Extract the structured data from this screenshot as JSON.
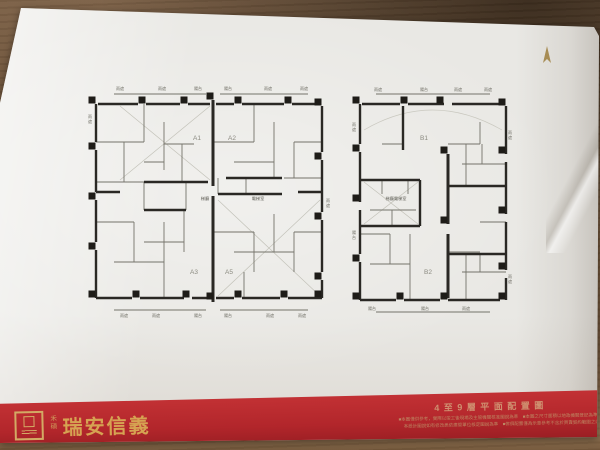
{
  "scene": {
    "desk_color": "#6c5238",
    "paper_color": "#e9e8e4",
    "band_color": "#b2262b",
    "gold": "#d3aa64"
  },
  "compass": {
    "direction": "N",
    "color": "#a78c54"
  },
  "footer": {
    "brand_small": "禾碩",
    "brand": "瑞安信義",
    "sheet_title": "4至9層平面配置圖",
    "disclaimer_line1": "■本圖僅供參考，實際以竣工後現場及主管機關核准圖說為準　■本圖之尺寸面積以地政機關登記為準",
    "disclaimer_line2": "本設計圖說如有修改悉依建管單位核定圖說為準　■傢俱配置僅為示意參考不含於買賣契約範圍之內"
  },
  "plans": [
    {
      "name": "tower-a-plan",
      "x": 86,
      "y": 84,
      "w": 246,
      "h": 236,
      "units": [
        {
          "label": "A1",
          "x": 111,
          "y": 56
        },
        {
          "label": "A2",
          "x": 146,
          "y": 56
        },
        {
          "label": "A3",
          "x": 108,
          "y": 190
        },
        {
          "label": "A5",
          "x": 143,
          "y": 190
        }
      ],
      "center_labels": [
        {
          "text": "梯廳",
          "x": 119,
          "y": 116
        },
        {
          "text": "電梯室",
          "x": 172,
          "y": 116
        }
      ],
      "edge_labels": [
        {
          "text": "雨遮",
          "x": 34,
          "y": 6
        },
        {
          "text": "雨遮",
          "x": 76,
          "y": 6
        },
        {
          "text": "陽台",
          "x": 112,
          "y": 6
        },
        {
          "text": "陽台",
          "x": 142,
          "y": 6
        },
        {
          "text": "雨遮",
          "x": 182,
          "y": 6
        },
        {
          "text": "雨遮",
          "x": 218,
          "y": 6
        },
        {
          "text": "雨遮",
          "x": 38,
          "y": 233
        },
        {
          "text": "雨遮",
          "x": 70,
          "y": 233
        },
        {
          "text": "陽台",
          "x": 112,
          "y": 233
        },
        {
          "text": "陽台",
          "x": 142,
          "y": 233
        },
        {
          "text": "雨遮",
          "x": 184,
          "y": 233
        },
        {
          "text": "雨遮",
          "x": 216,
          "y": 233
        },
        {
          "text": "雨遮",
          "x": 4,
          "y": 34,
          "v": true
        },
        {
          "text": "雨遮",
          "x": 242,
          "y": 118,
          "v": true
        }
      ],
      "walls": [
        [
          12,
          20,
          52,
          20
        ],
        [
          60,
          20,
          94,
          20
        ],
        [
          102,
          20,
          124,
          20
        ],
        [
          130,
          20,
          148,
          20
        ],
        [
          156,
          20,
          198,
          20
        ],
        [
          206,
          20,
          234,
          20
        ],
        [
          10,
          20,
          10,
          58
        ],
        [
          10,
          66,
          10,
          108
        ],
        [
          10,
          116,
          10,
          158
        ],
        [
          10,
          166,
          10,
          214
        ],
        [
          236,
          22,
          236,
          68
        ],
        [
          236,
          76,
          236,
          128
        ],
        [
          236,
          136,
          236,
          188
        ],
        [
          236,
          196,
          236,
          214
        ],
        [
          10,
          214,
          46,
          214
        ],
        [
          54,
          214,
          98,
          214
        ],
        [
          106,
          214,
          124,
          214
        ],
        [
          130,
          214,
          148,
          214
        ],
        [
          156,
          214,
          194,
          214
        ],
        [
          202,
          214,
          236,
          214
        ],
        [
          127,
          16,
          127,
          102,
          3
        ],
        [
          127,
          112,
          127,
          218,
          3
        ],
        [
          58,
          98,
          122,
          98
        ],
        [
          132,
          110,
          196,
          110
        ],
        [
          58,
          126,
          100,
          126
        ],
        [
          140,
          94,
          196,
          94
        ],
        [
          10,
          108,
          34,
          108
        ],
        [
          212,
          108,
          236,
          108
        ]
      ],
      "thin": [
        [
          10,
          58,
          58,
          58
        ],
        [
          58,
          20,
          58,
          58
        ],
        [
          38,
          58,
          38,
          98
        ],
        [
          10,
          98,
          58,
          98
        ],
        [
          78,
          38,
          78,
          86
        ],
        [
          78,
          60,
          108,
          60
        ],
        [
          96,
          60,
          96,
          98
        ],
        [
          58,
          78,
          78,
          78
        ],
        [
          127,
          58,
          168,
          58
        ],
        [
          168,
          20,
          168,
          58
        ],
        [
          188,
          38,
          188,
          94
        ],
        [
          148,
          78,
          188,
          78
        ],
        [
          208,
          58,
          236,
          58
        ],
        [
          198,
          94,
          236,
          94
        ],
        [
          208,
          58,
          208,
          94
        ],
        [
          10,
          138,
          48,
          138
        ],
        [
          48,
          138,
          48,
          178
        ],
        [
          28,
          178,
          78,
          178
        ],
        [
          78,
          138,
          78,
          214
        ],
        [
          98,
          126,
          98,
          168
        ],
        [
          58,
          158,
          98,
          158
        ],
        [
          127,
          148,
          168,
          148
        ],
        [
          168,
          148,
          168,
          188
        ],
        [
          148,
          168,
          208,
          168
        ],
        [
          188,
          130,
          188,
          168
        ],
        [
          208,
          148,
          236,
          148
        ],
        [
          158,
          188,
          158,
          214
        ],
        [
          208,
          148,
          208,
          188
        ],
        [
          100,
          98,
          100,
          126
        ],
        [
          132,
          94,
          132,
          110
        ],
        [
          160,
          94,
          160,
          110
        ],
        [
          58,
          98,
          58,
          126
        ],
        [
          28,
          10,
          120,
          10
        ],
        [
          134,
          10,
          222,
          10
        ],
        [
          28,
          226,
          120,
          226
        ],
        [
          134,
          226,
          222,
          226
        ]
      ],
      "faint": [
        [
          34,
          22,
          124,
          96
        ],
        [
          124,
          22,
          34,
          96
        ],
        [
          132,
          116,
          234,
          212
        ],
        [
          234,
          116,
          132,
          212
        ]
      ],
      "columns": [
        [
          6,
          16
        ],
        [
          56,
          16
        ],
        [
          98,
          16
        ],
        [
          124,
          12
        ],
        [
          152,
          16
        ],
        [
          202,
          16
        ],
        [
          232,
          18
        ],
        [
          6,
          62
        ],
        [
          6,
          112
        ],
        [
          6,
          162
        ],
        [
          6,
          210
        ],
        [
          232,
          72
        ],
        [
          232,
          132
        ],
        [
          232,
          192
        ],
        [
          232,
          210
        ],
        [
          50,
          210
        ],
        [
          100,
          210
        ],
        [
          124,
          212
        ],
        [
          152,
          210
        ],
        [
          198,
          210
        ]
      ]
    },
    {
      "name": "tower-b-plan",
      "x": 352,
      "y": 86,
      "w": 162,
      "h": 232,
      "units": [
        {
          "label": "B1",
          "x": 72,
          "y": 54
        },
        {
          "label": "B2",
          "x": 76,
          "y": 188
        }
      ],
      "center_labels": [
        {
          "text": "梯廳電梯室",
          "x": 44,
          "y": 114
        }
      ],
      "edge_labels": [
        {
          "text": "雨遮",
          "x": 26,
          "y": 5
        },
        {
          "text": "陽台",
          "x": 72,
          "y": 5
        },
        {
          "text": "雨遮",
          "x": 106,
          "y": 5
        },
        {
          "text": "雨遮",
          "x": 136,
          "y": 5
        },
        {
          "text": "陽台",
          "x": 20,
          "y": 224
        },
        {
          "text": "陽台",
          "x": 73,
          "y": 224
        },
        {
          "text": "雨遮",
          "x": 114,
          "y": 224
        },
        {
          "text": "雨遮",
          "x": 2,
          "y": 40,
          "v": true
        },
        {
          "text": "陽台",
          "x": 2,
          "y": 148,
          "v": true
        },
        {
          "text": "雨遮",
          "x": 158,
          "y": 48,
          "v": true
        },
        {
          "text": "雨遮",
          "x": 158,
          "y": 192,
          "v": true
        }
      ],
      "arc": "M 12 44 Q 80 4 150 44",
      "walls": [
        [
          10,
          18,
          48,
          18
        ],
        [
          56,
          18,
          92,
          18
        ],
        [
          100,
          18,
          148,
          18
        ],
        [
          8,
          18,
          8,
          58
        ],
        [
          8,
          66,
          8,
          116
        ],
        [
          8,
          124,
          8,
          168
        ],
        [
          8,
          176,
          8,
          214
        ],
        [
          154,
          20,
          154,
          68
        ],
        [
          154,
          76,
          154,
          128
        ],
        [
          154,
          136,
          154,
          184
        ],
        [
          154,
          192,
          154,
          214
        ],
        [
          8,
          214,
          44,
          214
        ],
        [
          52,
          214,
          88,
          214
        ],
        [
          96,
          214,
          148,
          214
        ],
        [
          96,
          68,
          96,
          138,
          3
        ],
        [
          96,
          148,
          96,
          212,
          3
        ],
        [
          51,
          20,
          51,
          64
        ],
        [
          8,
          94,
          68,
          94
        ],
        [
          68,
          94,
          68,
          140
        ],
        [
          8,
          140,
          68,
          140
        ],
        [
          96,
          100,
          154,
          100
        ],
        [
          96,
          168,
          154,
          168
        ]
      ],
      "thin": [
        [
          30,
          58,
          51,
          58
        ],
        [
          96,
          58,
          128,
          58
        ],
        [
          114,
          58,
          114,
          100
        ],
        [
          128,
          36,
          128,
          58
        ],
        [
          110,
          78,
          154,
          78
        ],
        [
          130,
          58,
          130,
          78
        ],
        [
          30,
          94,
          30,
          108
        ],
        [
          56,
          94,
          56,
          108
        ],
        [
          18,
          124,
          64,
          124
        ],
        [
          40,
          124,
          40,
          140
        ],
        [
          8,
          148,
          38,
          148
        ],
        [
          38,
          148,
          38,
          178
        ],
        [
          18,
          178,
          58,
          178
        ],
        [
          58,
          148,
          58,
          214
        ],
        [
          96,
          166,
          128,
          166
        ],
        [
          114,
          168,
          114,
          214
        ],
        [
          128,
          136,
          154,
          136
        ],
        [
          110,
          186,
          154,
          186
        ],
        [
          128,
          168,
          128,
          186
        ],
        [
          24,
          8,
          138,
          8
        ],
        [
          24,
          226,
          138,
          226
        ]
      ],
      "faint": [
        [
          12,
          96,
          66,
          138
        ],
        [
          66,
          96,
          12,
          138
        ]
      ],
      "columns": [
        [
          4,
          14
        ],
        [
          52,
          14
        ],
        [
          88,
          14
        ],
        [
          150,
          16
        ],
        [
          4,
          62
        ],
        [
          4,
          112
        ],
        [
          4,
          172
        ],
        [
          4,
          210
        ],
        [
          150,
          64
        ],
        [
          150,
          124
        ],
        [
          150,
          180
        ],
        [
          150,
          210
        ],
        [
          48,
          210
        ],
        [
          92,
          210
        ],
        [
          92,
          64
        ],
        [
          92,
          134
        ]
      ]
    }
  ]
}
